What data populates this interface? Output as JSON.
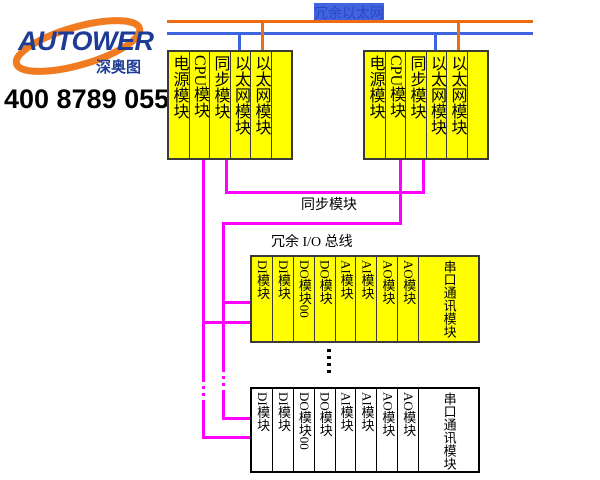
{
  "logo": {
    "brand": "AUTOWER",
    "sub_brand": "深奥图",
    "phone": "400 8789 055"
  },
  "diagram": {
    "ethernet_label": "冗余以太网",
    "sync_label": "同步模块",
    "io_bus_label": "冗余 I/O 总线"
  },
  "racks": {
    "left_controller": {
      "modules": [
        "电源模块",
        "CPU模块",
        "同步模块",
        "以太网模块",
        "以太网模块",
        ""
      ]
    },
    "right_controller": {
      "modules": [
        "电源模块",
        "CPU模块",
        "同步模块",
        "以太网模块",
        "以太网模块",
        ""
      ]
    },
    "io_top": {
      "modules": [
        "DI模块",
        "DI模块",
        "DO模块00",
        "DO模块",
        "AI模块",
        "AI模块",
        "AO模块",
        "AO模块",
        "串口通讯模块"
      ]
    },
    "io_bottom": {
      "modules": [
        "DI模块",
        "DI模块",
        "DO模块00",
        "DO模块",
        "AI模块",
        "AI模块",
        "AO模块",
        "AO模块",
        "串口通讯模块"
      ]
    }
  },
  "colors": {
    "ethernet_line_a": "#ee6c0f",
    "ethernet_line_b": "#3f64e0",
    "bus_line": "#ff00ff",
    "module_fill_top": "#ffff00",
    "module_fill_bottom": "#ffffff",
    "label_blue": "#2f45c8",
    "brand_navy": "#1e3c96",
    "brand_orange": "#f07b20"
  }
}
